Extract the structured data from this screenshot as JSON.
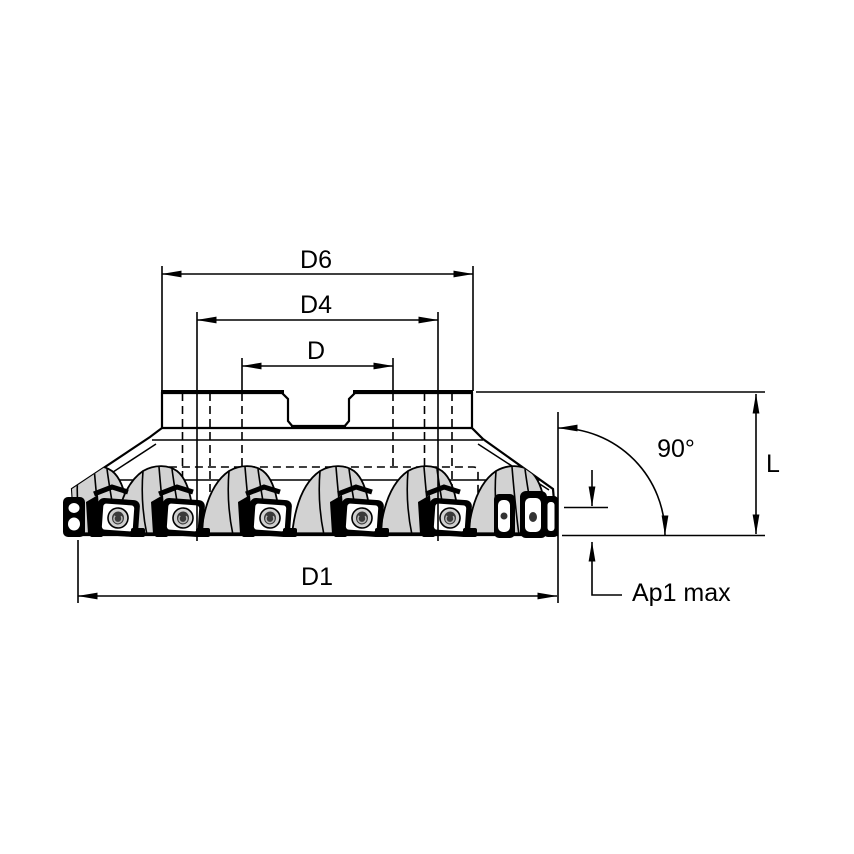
{
  "diagram": {
    "type": "technical-drawing",
    "subject": "indexable-insert face milling cutter, side view with dimension callouts",
    "colors": {
      "background": "#ffffff",
      "body_fill": "#d2d2d2",
      "line": "#000000",
      "insert_fill": "#ffffff",
      "screw_fill": "#cfcfcf"
    },
    "dimensions": {
      "d6": {
        "label": "D6"
      },
      "d4": {
        "label": "D4"
      },
      "d": {
        "label": "D"
      },
      "d1": {
        "label": "D1"
      },
      "length": {
        "label": "L"
      },
      "angle": {
        "label": "90°"
      },
      "depth": {
        "label": "Ap1 max"
      }
    }
  }
}
